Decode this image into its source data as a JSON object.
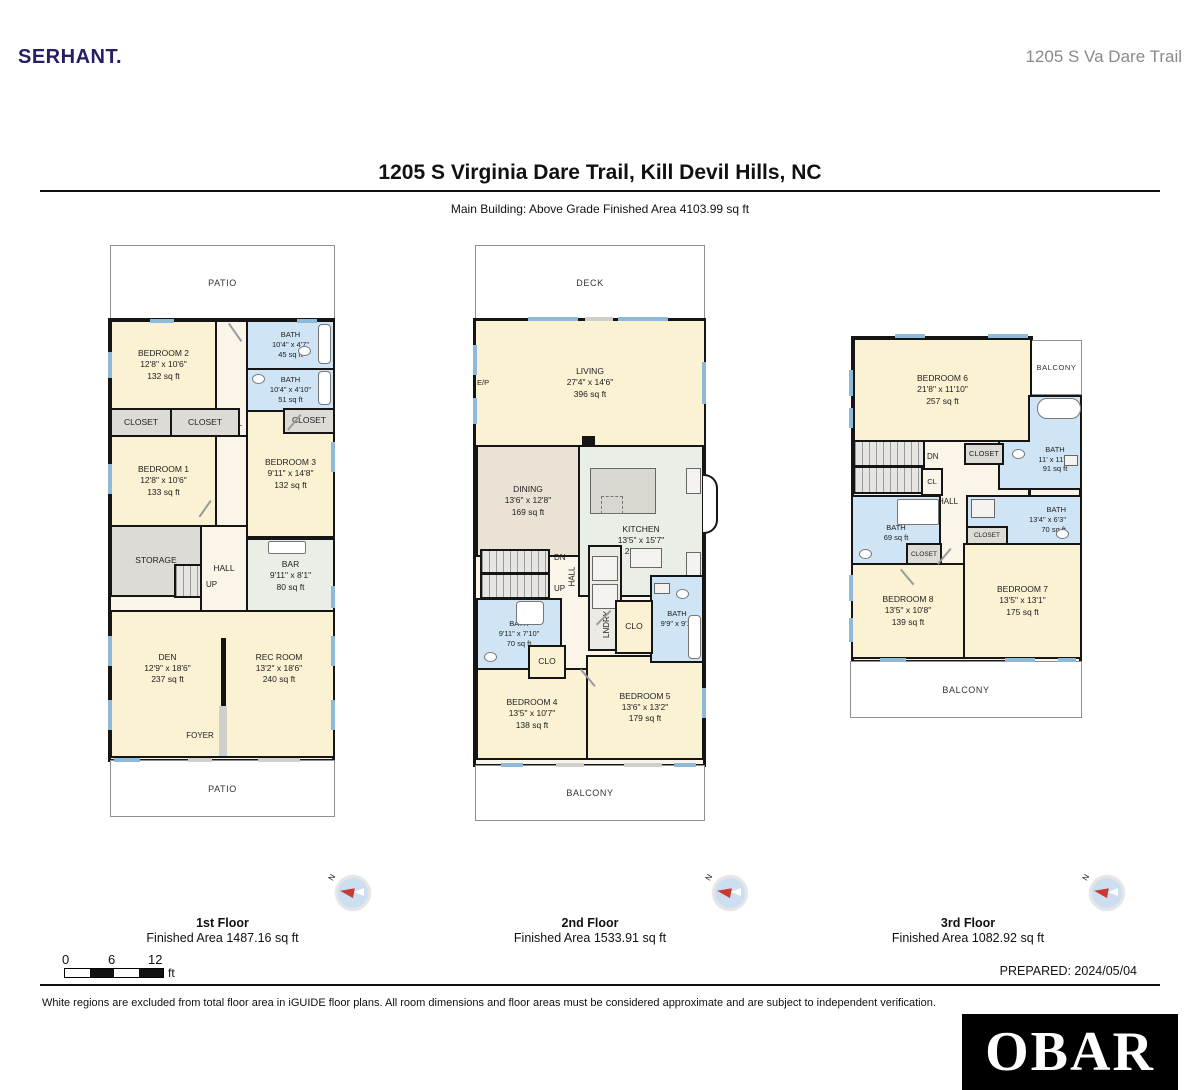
{
  "page": {
    "brand": "SERHANT.",
    "address_header": "1205 S Va Dare Trail",
    "title": "1205 S Virginia Dare Trail, Kill Devil Hills, NC",
    "subtitle": "Main Building: Above Grade Finished Area 4103.99 sq ft",
    "prepared": "PREPARED: 2024/05/04",
    "disclaimer": "White regions are excluded from total floor area in iGUIDE floor plans. All room dimensions and floor areas must be considered approximate and are subject to independent verification.",
    "iguide_logo": "iGUIDE",
    "obar_logo": "OBAR",
    "compass_n": "N"
  },
  "scale_bar": {
    "zero": "0",
    "six": "6",
    "twelve": "12",
    "unit": "ft"
  },
  "f1": {
    "label": "1st Floor",
    "area_label": "Finished Area 1487.16 sq ft",
    "patio_top": "PATIO",
    "patio_bottom": "PATIO",
    "foyer": "FOYER",
    "up": "UP",
    "hall_top": "HALL",
    "hall_mid": "HALL",
    "storage": "STORAGE",
    "closet1": "CLOSET",
    "closet2": "CLOSET",
    "closet3": "CLOSET",
    "bedroom2": {
      "name": "BEDROOM 2",
      "dims": "12'8\" x 10'6\"",
      "area": "132 sq ft"
    },
    "bath1": {
      "name": "BATH",
      "dims": "10'4\" x 4'7\"",
      "area": "45 sq ft"
    },
    "bath2": {
      "name": "BATH",
      "dims": "10'4\" x 4'10\"",
      "area": "51 sq ft"
    },
    "bedroom1": {
      "name": "BEDROOM 1",
      "dims": "12'8\" x 10'6\"",
      "area": "133 sq ft"
    },
    "bedroom3": {
      "name": "BEDROOM 3",
      "dims": "9'11\" x 14'8\"",
      "area": "132 sq ft"
    },
    "bar": {
      "name": "BAR",
      "dims": "9'11\" x 8'1\"",
      "area": "80 sq ft"
    },
    "den": {
      "name": "DEN",
      "dims": "12'9\" x 18'6\"",
      "area": "237 sq ft"
    },
    "rec_room": {
      "name": "REC ROOM",
      "dims": "13'2\" x 18'6\"",
      "area": "240 sq ft"
    }
  },
  "f2": {
    "label": "2nd Floor",
    "area_label": "Finished Area 1533.91 sq ft",
    "deck": "DECK",
    "balcony": "BALCONY",
    "ep": "E/P",
    "dn": "DN",
    "up": "UP",
    "hall": "HALL",
    "lndry": "LNDRY",
    "clo1": "CLO",
    "clo2": "CLO",
    "living": {
      "name": "LIVING",
      "dims": "27'4\" x 14'6\"",
      "area": "396 sq ft"
    },
    "dining": {
      "name": "DINING",
      "dims": "13'6\" x 12'8\"",
      "area": "169 sq ft"
    },
    "kitchen": {
      "name": "KITCHEN",
      "dims": "13'5\" x 15'7\"",
      "area": "212 sq ft"
    },
    "bath1": {
      "name": "BATH",
      "dims": "9'11\" x 7'10\"",
      "area": "70 sq ft"
    },
    "bath2": {
      "name": "BATH",
      "dims": "9'9\" x 9'1\""
    },
    "bedroom4": {
      "name": "BEDROOM 4",
      "dims": "13'5\" x 10'7\"",
      "area": "138 sq ft"
    },
    "bedroom5": {
      "name": "BEDROOM 5",
      "dims": "13'6\" x 13'2\"",
      "area": "179 sq ft"
    }
  },
  "f3": {
    "label": "3rd Floor",
    "area_label": "Finished Area 1082.92 sq ft",
    "balcony_top": "BALCONY",
    "balcony_bottom": "BALCONY",
    "dn": "DN",
    "cl": "CL",
    "hall": "HALL",
    "closet_top": "CLOSET",
    "closet_left": "CLOSET",
    "closet_right": "CLOSET",
    "bedroom6": {
      "name": "BEDROOM 6",
      "dims": "21'8\" x 11'10\"",
      "area": "257 sq ft"
    },
    "bath1": {
      "name": "BATH",
      "dims": "11' x 11'3\"",
      "area": "91 sq ft"
    },
    "bath2": {
      "name": "BATH",
      "area": "69 sq ft"
    },
    "bath3": {
      "name": "BATH",
      "dims": "13'4\" x 6'3\"",
      "area": "70 sq ft"
    },
    "bedroom7": {
      "name": "BEDROOM 7",
      "dims": "13'5\" x 13'1\"",
      "area": "175 sq ft"
    },
    "bedroom8": {
      "name": "BEDROOM 8",
      "dims": "13'5\" x 10'8\"",
      "area": "139 sq ft"
    }
  },
  "colors": {
    "brand_navy": "#232063",
    "room_cream": "#fbf1d3",
    "bath_blue": "#cfe4f5",
    "closet_gray": "#dcdbd6",
    "kitchen_sage": "#e9efe7",
    "dining_tan": "#eae2d4",
    "window_blue": "#8fb9d9",
    "wall_black": "#151515",
    "iguide_blue": "#6cb0d5",
    "compass_red": "#c93a30"
  }
}
